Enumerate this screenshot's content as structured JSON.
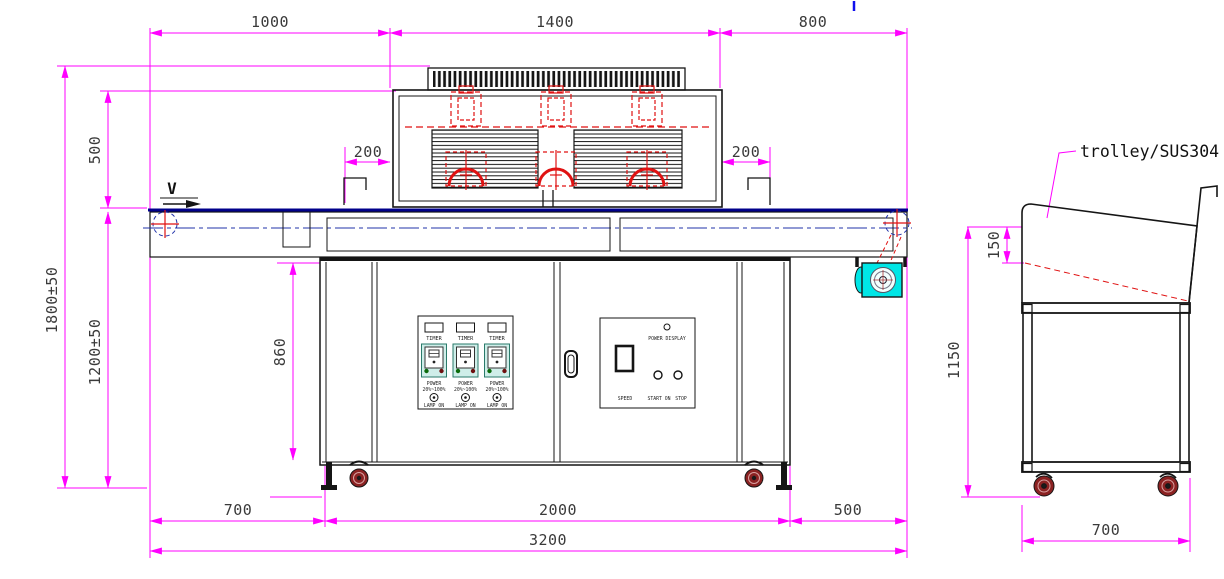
{
  "front_view": {
    "dims": {
      "top_left": "1000",
      "top_mid": "1400",
      "top_right": "800",
      "overall_height": "1800±50",
      "hood_height": "500",
      "belt_height": "1200±50",
      "hood_offset_left": "200",
      "hood_offset_right": "200",
      "cabinet_height": "860",
      "bottom_left": "700",
      "bottom_mid": "2000",
      "bottom_right": "500",
      "overall_length": "3200"
    },
    "velocity_marker": "V",
    "control_panel_left": {
      "channels": [
        {
          "timer": "TIMER",
          "power": "POWER",
          "range": "20%~100%",
          "lamp": "LAMP ON"
        },
        {
          "timer": "TIMER",
          "power": "POWER",
          "range": "20%~100%",
          "lamp": "LAMP ON"
        },
        {
          "timer": "TIMER",
          "power": "POWER",
          "range": "20%~100%",
          "lamp": "LAMP ON"
        }
      ]
    },
    "control_panel_right": {
      "power_display": "POWER DISPLAY",
      "speed": "SPEED",
      "start": "START ON",
      "stop": "STOP"
    }
  },
  "side_view": {
    "label": "trolley/SUS304",
    "dims": {
      "tray_depth": "150",
      "height": "1150",
      "width": "700"
    }
  },
  "colors": {
    "dimension": "#ff00ff",
    "detail_red": "#e01212",
    "conveyor_navy": "#00008b",
    "centerline_blue": "#2233aa",
    "motor_cyan": "#00e6e6",
    "caster_red": "#8b2222",
    "controller_mint": "#cfeee9"
  }
}
